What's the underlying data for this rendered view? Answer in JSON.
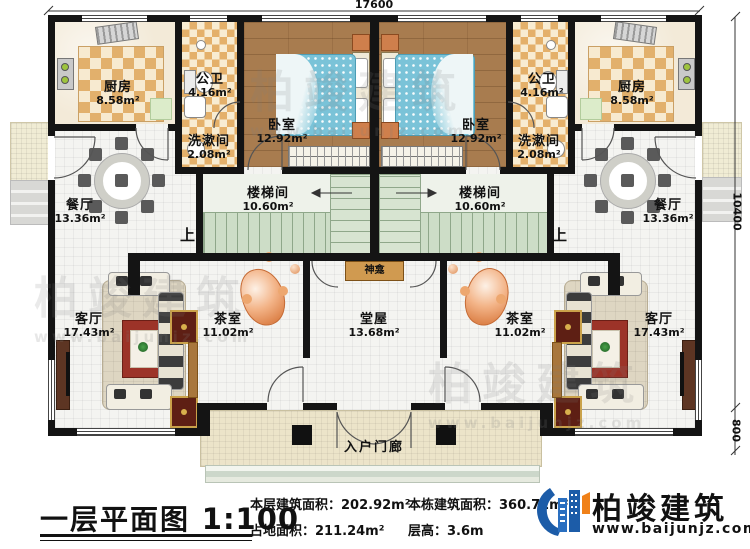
{
  "title": {
    "text": "一层平面图",
    "scale": "1:100"
  },
  "stats": {
    "floor_area_label": "本层建筑面积：",
    "floor_area_value": "202.92m²",
    "site_area_label": "占地面积：",
    "site_area_value": "211.24m²",
    "total_area_label": "本栋建筑面积：",
    "total_area_value": "360.72m²",
    "storey_height_label": "层高：",
    "storey_height_value": "3.6m"
  },
  "brand": {
    "name": "柏竣建筑",
    "url": "www.baijunjz.com"
  },
  "watermark": {
    "name": "柏竣建筑",
    "url": "www.baijunjz.com"
  },
  "dimensions": {
    "top": "17600",
    "right_upper": "10400",
    "right_lower": "800"
  },
  "labels": {
    "shrine": "神龛",
    "entry_porch": "入户门廊",
    "stairs_up": "上"
  },
  "rooms": {
    "kitchen": {
      "name": "厨房",
      "area": "8.58m²"
    },
    "public_bath": {
      "name": "公卫",
      "area": "4.16m²"
    },
    "washroom": {
      "name": "洗漱间",
      "area": "2.08m²"
    },
    "bedroom": {
      "name": "卧室",
      "area": "12.92m²"
    },
    "dining": {
      "name": "餐厅",
      "area": "13.36m²"
    },
    "stairwell": {
      "name": "楼梯间",
      "area": "10.60m²"
    },
    "living": {
      "name": "客厅",
      "area": "17.43m²"
    },
    "tea_room": {
      "name": "茶室",
      "area": "11.02m²"
    },
    "hall": {
      "name": "堂屋",
      "area": "13.68m²"
    }
  },
  "colors": {
    "wall": "#141414",
    "checker_tile": "#e2b06c",
    "wood_floor": "#a87c4f",
    "bed": "#7ac3d8",
    "stair": "#cdddc7",
    "porch": "#ece4c9",
    "shrine": "#d09a50",
    "brand_blue": "#1c5ca8",
    "brand_orange": "#f08119"
  }
}
